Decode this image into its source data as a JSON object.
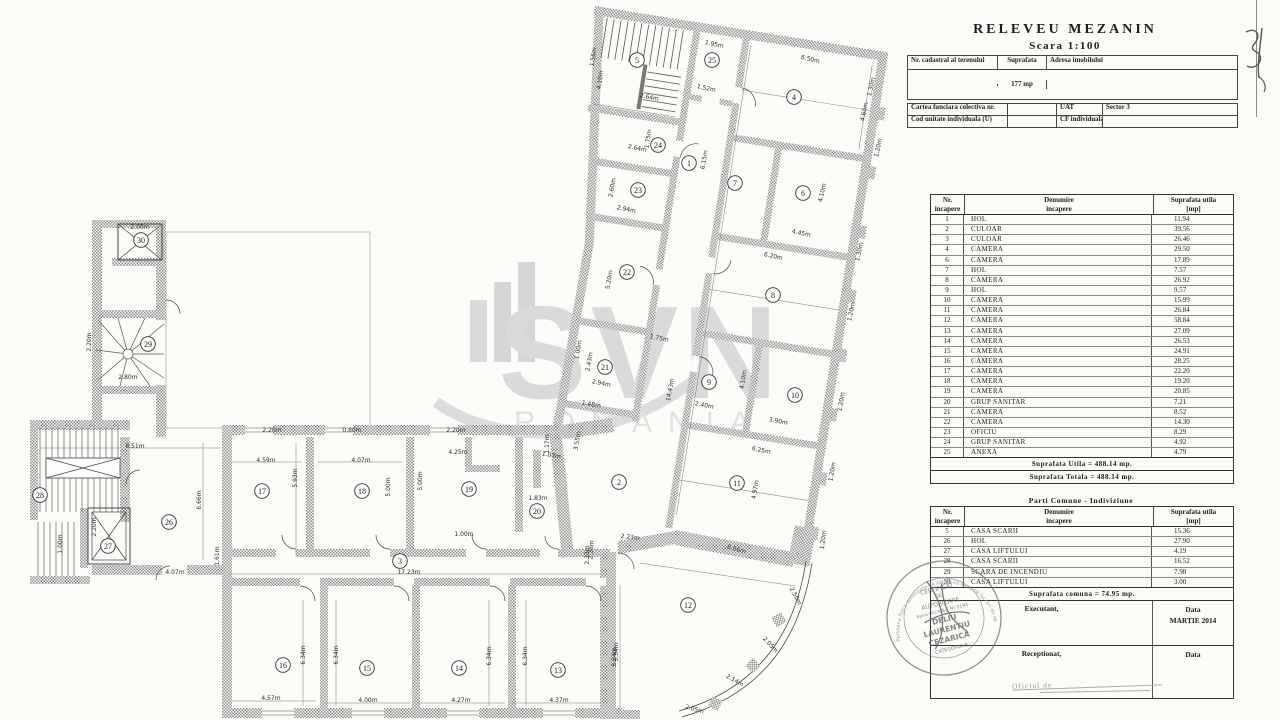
{
  "title": {
    "line1": "RELEVEU MEZANIN",
    "line2": "Scara 1:100"
  },
  "handwriting": {
    "page_number": "31"
  },
  "watermark": {
    "line1": "SVN",
    "line2": "ROMANIA"
  },
  "cadastral": {
    "col_nr": "Nr. cadastral al terenului",
    "col_suprafata": "Suprafata",
    "col_adresa": "Adresa imobilului",
    "suprafata_value": "177 mp",
    "cartea_label": "Cartea funciara colectiva nr.",
    "uat_label": "UAT",
    "uat_value": "Sector 3",
    "cod_label": "Cod unitate individuala (U)",
    "cf_label": "CF individuala",
    "cf_value": ""
  },
  "rooms_table": {
    "headers": {
      "nr1": "Nr.",
      "nr2": "incapere",
      "den1": "Denumire",
      "den2": "incapere",
      "sup1": "Suprafata utila",
      "sup2": "[mp]"
    },
    "rows": [
      [
        "1",
        "HOL",
        "11.94"
      ],
      [
        "2",
        "CULOAR",
        "39.56"
      ],
      [
        "3",
        "CULOAR",
        "26.46"
      ],
      [
        "4",
        "CAMERA",
        "29.50"
      ],
      [
        "6",
        "CAMERA",
        "17.89"
      ],
      [
        "7",
        "HOL",
        "7.57"
      ],
      [
        "8",
        "CAMERA",
        "26.92"
      ],
      [
        "9",
        "HOL",
        "9.57"
      ],
      [
        "10",
        "CAMERA",
        "15.99"
      ],
      [
        "11",
        "CAMERA",
        "26.84"
      ],
      [
        "12",
        "CAMERA",
        "58.84"
      ],
      [
        "13",
        "CAMERA",
        "27.09"
      ],
      [
        "14",
        "CAMERA",
        "26.53"
      ],
      [
        "15",
        "CAMERA",
        "24.91"
      ],
      [
        "16",
        "CAMERA",
        "28.25"
      ],
      [
        "17",
        "CAMERA",
        "22.20"
      ],
      [
        "18",
        "CAMERA",
        "19.20"
      ],
      [
        "19",
        "CAMERA",
        "20.85"
      ],
      [
        "20",
        "GRUP SANITAR",
        "7.21"
      ],
      [
        "21",
        "CAMERA",
        "8.52"
      ],
      [
        "22",
        "CAMERA",
        "14.30"
      ],
      [
        "23",
        "OFICIU",
        "8.29"
      ],
      [
        "24",
        "GRUP SANITAR",
        "4.92"
      ],
      [
        "25",
        "ANEXA",
        "4.79"
      ]
    ],
    "total_utila": "Suprafata Utila = 488.14 mp.",
    "total_totala": "Suprafata Totala = 488.14 mp."
  },
  "common_table": {
    "title": "Parti Comune - Indiviziune",
    "headers": {
      "nr1": "Nr.",
      "nr2": "incapere",
      "den1": "Denumire",
      "den2": "incapere",
      "sup1": "Suprafata utila",
      "sup2": "[mp]"
    },
    "rows": [
      [
        "5",
        "CASA SCARII",
        "15.36"
      ],
      [
        "26",
        "HOL",
        "27.90"
      ],
      [
        "27",
        "CASA LIFTULUI",
        "4.19"
      ],
      [
        "28",
        "CASA SCARII",
        "16.52"
      ],
      [
        "29",
        "SCARA DE INCENDIU",
        "7.98"
      ],
      [
        "30",
        "CASA LIFTULUI",
        "3.00"
      ]
    ],
    "total": "Suprafata comuna = 74.95 mp.",
    "executant_label": "Executant,",
    "executant_data_label": "Data",
    "executant_date": "MARTIE 2014",
    "receptionat_label": "Receptionat,",
    "receptionat_data_label": "Data",
    "footer_note": "Oficiul de"
  },
  "stamp": {
    "outer_text": "Persoana fizica autorizata de ANCPI sa execute lucrari de specialitate",
    "lines": [
      "CERTIFICAT",
      "DE",
      "AUTORIZARE",
      "Seria RO-MB-F Nr 0194",
      "DELIU",
      "LAURENTIU",
      "CEZARICA",
      "CATEGORIA B"
    ]
  },
  "plan": {
    "rooms": [
      {
        "n": "1",
        "x": 689,
        "y": 163
      },
      {
        "n": "2",
        "x": 619,
        "y": 482
      },
      {
        "n": "3",
        "x": 400,
        "y": 561
      },
      {
        "n": "4",
        "x": 794,
        "y": 97
      },
      {
        "n": "5",
        "x": 637,
        "y": 60
      },
      {
        "n": "6",
        "x": 803,
        "y": 193
      },
      {
        "n": "7",
        "x": 735,
        "y": 183
      },
      {
        "n": "8",
        "x": 773,
        "y": 295
      },
      {
        "n": "9",
        "x": 709,
        "y": 382
      },
      {
        "n": "10",
        "x": 795,
        "y": 395
      },
      {
        "n": "11",
        "x": 737,
        "y": 483
      },
      {
        "n": "12",
        "x": 688,
        "y": 605
      },
      {
        "n": "13",
        "x": 558,
        "y": 670
      },
      {
        "n": "14",
        "x": 459,
        "y": 668
      },
      {
        "n": "15",
        "x": 367,
        "y": 668
      },
      {
        "n": "16",
        "x": 283,
        "y": 665
      },
      {
        "n": "17",
        "x": 262,
        "y": 491
      },
      {
        "n": "18",
        "x": 362,
        "y": 491
      },
      {
        "n": "19",
        "x": 469,
        "y": 489
      },
      {
        "n": "20",
        "x": 537,
        "y": 511
      },
      {
        "n": "21",
        "x": 605,
        "y": 367
      },
      {
        "n": "22",
        "x": 627,
        "y": 272
      },
      {
        "n": "23",
        "x": 638,
        "y": 190
      },
      {
        "n": "24",
        "x": 658,
        "y": 145
      },
      {
        "n": "25",
        "x": 712,
        "y": 60
      },
      {
        "n": "26",
        "x": 169,
        "y": 522
      },
      {
        "n": "27",
        "x": 108,
        "y": 546
      },
      {
        "n": "28",
        "x": 40,
        "y": 495
      },
      {
        "n": "29",
        "x": 148,
        "y": 344
      },
      {
        "n": "30",
        "x": 141,
        "y": 240
      }
    ],
    "dims": [
      {
        "t": "2.64m",
        "x": 649,
        "y": 99,
        "r": 12
      },
      {
        "t": "1.95m",
        "x": 714,
        "y": 46,
        "r": 12
      },
      {
        "t": "1.52m",
        "x": 706,
        "y": 90,
        "r": 12
      },
      {
        "t": "6.50m",
        "x": 810,
        "y": 61,
        "r": 13
      },
      {
        "t": "2.64m",
        "x": 637,
        "y": 150,
        "r": 12
      },
      {
        "t": "2.94m",
        "x": 626,
        "y": 211,
        "r": 12
      },
      {
        "t": "2.94m",
        "x": 601,
        "y": 385,
        "r": 11
      },
      {
        "t": "1.48m",
        "x": 591,
        "y": 406,
        "r": 10
      },
      {
        "t": "4.45m",
        "x": 801,
        "y": 235,
        "r": 12
      },
      {
        "t": "6.20m",
        "x": 773,
        "y": 258,
        "r": 12
      },
      {
        "t": "2.40m",
        "x": 704,
        "y": 407,
        "r": 11
      },
      {
        "t": "3.90m",
        "x": 778,
        "y": 423,
        "r": 11
      },
      {
        "t": "6.25m",
        "x": 761,
        "y": 452,
        "r": 11
      },
      {
        "t": "1.75m",
        "x": 659,
        "y": 340,
        "r": 11
      },
      {
        "t": "8.66m",
        "x": 736,
        "y": 551,
        "r": 16
      },
      {
        "t": "1.56m",
        "x": 595,
        "y": 57,
        "r": -82
      },
      {
        "t": "4.10m",
        "x": 602,
        "y": 80,
        "r": -82
      },
      {
        "t": "4.60m",
        "x": 866,
        "y": 112,
        "r": -78
      },
      {
        "t": "1.75m",
        "x": 650,
        "y": 139,
        "r": -82
      },
      {
        "t": "2.60m",
        "x": 614,
        "y": 188,
        "r": -80
      },
      {
        "t": "5.20m",
        "x": 611,
        "y": 280,
        "r": -80
      },
      {
        "t": "2.43m",
        "x": 591,
        "y": 362,
        "r": -80
      },
      {
        "t": "1.00m",
        "x": 580,
        "y": 350,
        "r": -80
      },
      {
        "t": "6.15m",
        "x": 706,
        "y": 160,
        "r": -80
      },
      {
        "t": "14.43m",
        "x": 672,
        "y": 390,
        "r": -80
      },
      {
        "t": "4.10m",
        "x": 824,
        "y": 193,
        "r": -78
      },
      {
        "t": "4.10m",
        "x": 745,
        "y": 380,
        "r": -80
      },
      {
        "t": "4.97m",
        "x": 757,
        "y": 490,
        "r": -80
      },
      {
        "t": "3.55m",
        "x": 579,
        "y": 441,
        "r": -80
      },
      {
        "t": "1.30m",
        "x": 873,
        "y": 87,
        "r": -78
      },
      {
        "t": "1.20m",
        "x": 880,
        "y": 148,
        "r": -78
      },
      {
        "t": "1.30m",
        "x": 861,
        "y": 252,
        "r": -78
      },
      {
        "t": "1.20m",
        "x": 853,
        "y": 312,
        "r": -79
      },
      {
        "t": "1.20m",
        "x": 843,
        "y": 402,
        "r": -80
      },
      {
        "t": "1.20m",
        "x": 834,
        "y": 472,
        "r": -81
      },
      {
        "t": "1.20m",
        "x": 825,
        "y": 540,
        "r": -83
      },
      {
        "t": "2.50m",
        "x": 794,
        "y": 597,
        "r": 62
      },
      {
        "t": "2.05m",
        "x": 769,
        "y": 646,
        "r": 47
      },
      {
        "t": "2.14m",
        "x": 734,
        "y": 682,
        "r": 30
      },
      {
        "t": "2.05m",
        "x": 694,
        "y": 711,
        "r": 16
      },
      {
        "t": "2.23m",
        "x": 630,
        "y": 539,
        "r": 7
      },
      {
        "t": "2.33m",
        "x": 589,
        "y": 555,
        "r": -90
      },
      {
        "t": "5.34m",
        "x": 616,
        "y": 657,
        "r": -90
      },
      {
        "t": "2.38m",
        "x": 593,
        "y": 550,
        "r": -86
      },
      {
        "t": "8.51m",
        "x": 135,
        "y": 448,
        "r": 0
      },
      {
        "t": "4.07m",
        "x": 175,
        "y": 574,
        "r": 0
      },
      {
        "t": "4.59m",
        "x": 266,
        "y": 462,
        "r": 0
      },
      {
        "t": "4.07m",
        "x": 361,
        "y": 462,
        "r": 0
      },
      {
        "t": "2.20m",
        "x": 272,
        "y": 432,
        "r": 0
      },
      {
        "t": "0.80m",
        "x": 352,
        "y": 432,
        "r": 0
      },
      {
        "t": "4.25m",
        "x": 458,
        "y": 454,
        "r": 0
      },
      {
        "t": "2.20m",
        "x": 456,
        "y": 432,
        "r": 0
      },
      {
        "t": "1.83m",
        "x": 538,
        "y": 500,
        "r": 0
      },
      {
        "t": "17.23m",
        "x": 409,
        "y": 574,
        "r": 0
      },
      {
        "t": "1.00m",
        "x": 464,
        "y": 536,
        "r": 0
      },
      {
        "t": "1.03m",
        "x": 551,
        "y": 457,
        "r": 10
      },
      {
        "t": "4.57m",
        "x": 271,
        "y": 700,
        "r": 0
      },
      {
        "t": "4.00m",
        "x": 368,
        "y": 702,
        "r": 0
      },
      {
        "t": "4.27m",
        "x": 461,
        "y": 702,
        "r": 0
      },
      {
        "t": "4.37m",
        "x": 559,
        "y": 702,
        "r": 0
      },
      {
        "t": "2.80m",
        "x": 128,
        "y": 379,
        "r": 0
      },
      {
        "t": "2.00m",
        "x": 140,
        "y": 229,
        "r": 0
      },
      {
        "t": "6.66m",
        "x": 201,
        "y": 500,
        "r": -90
      },
      {
        "t": "2.20m",
        "x": 96,
        "y": 527,
        "r": -90
      },
      {
        "t": "5.93m",
        "x": 297,
        "y": 478,
        "r": -90
      },
      {
        "t": "5.00m",
        "x": 390,
        "y": 487,
        "r": -90
      },
      {
        "t": "5.00m",
        "x": 422,
        "y": 481,
        "r": -90
      },
      {
        "t": "1.17m",
        "x": 549,
        "y": 444,
        "r": -90
      },
      {
        "t": "6.34m",
        "x": 305,
        "y": 655,
        "r": -90
      },
      {
        "t": "6.34m",
        "x": 338,
        "y": 655,
        "r": -90
      },
      {
        "t": "6.34m",
        "x": 491,
        "y": 656,
        "r": -90
      },
      {
        "t": "6.34m",
        "x": 527,
        "y": 656,
        "r": -90
      },
      {
        "t": "5.34m",
        "x": 618,
        "y": 652,
        "r": -90
      },
      {
        "t": "1.00m",
        "x": 62,
        "y": 544,
        "r": -90
      },
      {
        "t": "2.20m",
        "x": 91,
        "y": 342,
        "r": -90
      },
      {
        "t": "1.61m",
        "x": 219,
        "y": 556,
        "r": -90
      }
    ]
  }
}
